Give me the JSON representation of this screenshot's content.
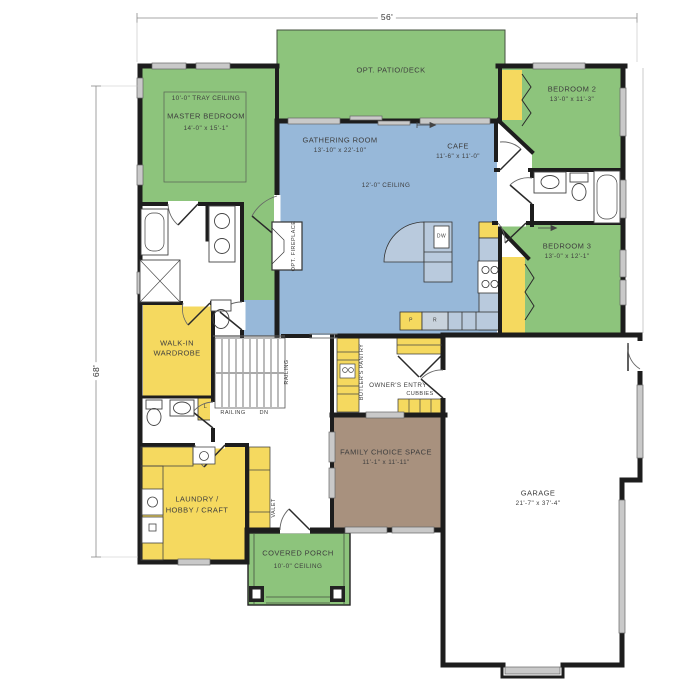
{
  "plan": {
    "dimensions": {
      "width": "56'",
      "height": "68'"
    },
    "rooms": {
      "patio": {
        "name": "OPT. PATIO/DECK"
      },
      "master": {
        "name": "MASTER BEDROOM",
        "dims": "14'-0\" x 15'-1\"",
        "ceiling": "10'-0\" TRAY CEILING"
      },
      "gathering": {
        "name": "GATHERING ROOM",
        "dims": "13'-10\" x 22'-10\"",
        "ceiling": "12'-0\" CEILING"
      },
      "cafe": {
        "name": "CAFE",
        "dims": "11'-6\" x 11'-0\""
      },
      "bedroom2": {
        "name": "BEDROOM 2",
        "dims": "13'-0\" x 11'-3\""
      },
      "bedroom3": {
        "name": "BEDROOM 3",
        "dims": "13'-0\" x 12'-1\""
      },
      "family": {
        "name": "FAMILY CHOICE SPACE",
        "dims": "11'-1\" x 11'-11\""
      },
      "garage": {
        "name": "GARAGE",
        "dims": "21'-7\" x 37'-4\""
      },
      "laundry": {
        "line1": "LAUNDRY /",
        "line2": "HOBBY / CRAFT"
      },
      "walkin": {
        "line1": "WALK-IN",
        "line2": "WARDROBE"
      },
      "porch": {
        "name": "COVERED PORCH",
        "ceiling": "10'-0\" CEILING"
      },
      "owners_entry": {
        "name": "OWNER'S ENTRY"
      },
      "butlers_pantry": {
        "name": "BUTLER'S PANTRY"
      },
      "cubbies": {
        "name": "CUBBIES"
      },
      "valet": {
        "name": "VALET"
      },
      "fireplace": {
        "name": "OPT. FIREPLACE"
      }
    },
    "annotations": {
      "railing_v": "RAILING",
      "railing_h": "RAILING",
      "down": "DN",
      "linen": "L",
      "pantry": "P",
      "refrigerator": "R",
      "dishwasher": "DW"
    },
    "colors": {
      "bedroom_green": "#8dc47c",
      "living_blue": "#97b8d9",
      "storage_yellow": "#f5d95f",
      "flex_taupe": "#a8917e",
      "counter_blue": "#b9cadd",
      "wall": "#1d1d1d",
      "window_gray": "#c9c9c9"
    }
  }
}
